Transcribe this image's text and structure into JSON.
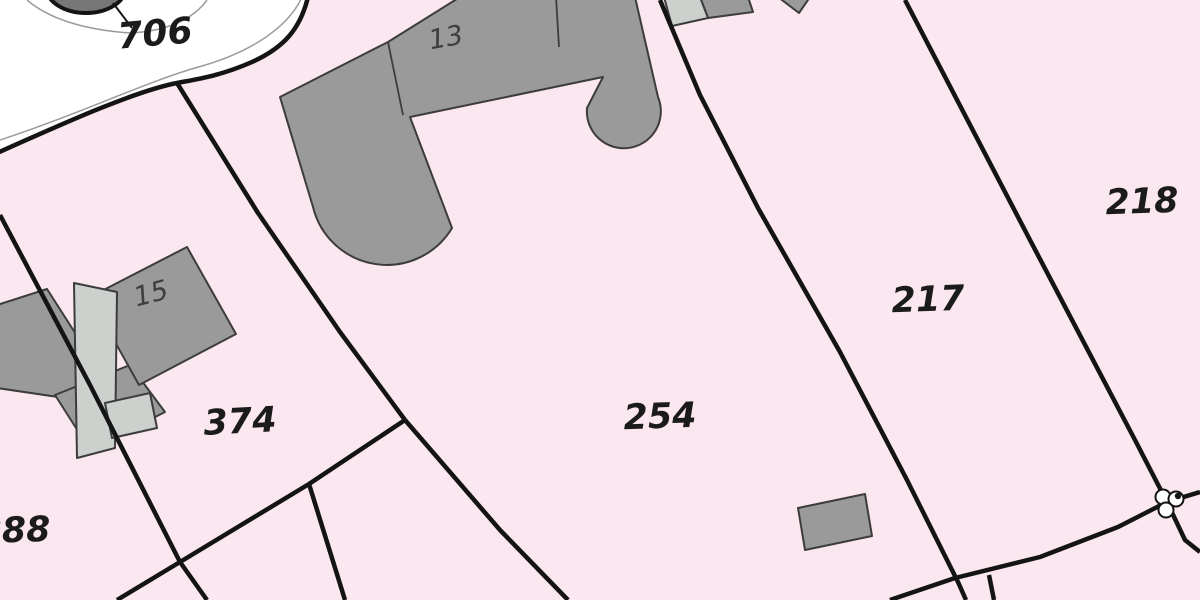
{
  "map": {
    "width": 1200,
    "height": 600,
    "colors": {
      "parcel_fill": "#fbe7ef",
      "road_fill": "#ffffff",
      "boundary": "#141414",
      "thin_line": "#9b9b9b",
      "building_dark": "#9a9a9a",
      "building_light": "#cdd1ce",
      "building_stroke": "#3c3c3c",
      "parcel_label_color": "#1b1b1b",
      "house_label_color": "#3e3e3e",
      "pond_fill": "#777777",
      "marker_fill": "#ffffff"
    },
    "parcel_labels": [
      {
        "id": "706",
        "text": "706",
        "x": 155,
        "y": 34,
        "size": 36,
        "rot": -5
      },
      {
        "id": "888",
        "text": "888",
        "x": 14,
        "y": 531,
        "size": 35,
        "rot": -2
      },
      {
        "id": "374",
        "text": "374",
        "x": 240,
        "y": 422,
        "size": 35,
        "rot": -3
      },
      {
        "id": "254",
        "text": "254",
        "x": 660,
        "y": 417,
        "size": 35,
        "rot": -2
      },
      {
        "id": "217",
        "text": "217",
        "x": 928,
        "y": 300,
        "size": 35,
        "rot": -2
      },
      {
        "id": "218",
        "text": "218",
        "x": 1142,
        "y": 202,
        "size": 35,
        "rot": -2
      }
    ],
    "house_labels": [
      {
        "id": "13",
        "text": "13",
        "x": 446,
        "y": 38,
        "size": 27,
        "rot": -10
      },
      {
        "id": "15",
        "text": "15",
        "x": 151,
        "y": 294,
        "size": 27,
        "rot": -15
      }
    ],
    "road_area_path": "M -3,-3 L 308,-3 C 300,30 283,48 252,62 C 220,76 198,79 177,83 C 135,91 62,124 -3,153 Z",
    "road_boundary_path": "M 308,-3 C 300,30 283,48 252,62 C 220,76 198,79 177,83 C 135,91 62,124 -3,153",
    "thin_curves": [
      {
        "id": "pond-ring",
        "path": "M 27,0 Q 60,28 130,33 Q 185,30 207,0"
      },
      {
        "id": "road-edge",
        "path": "M 302,-3 C 288,28 250,52 202,66 C 150,80 80,114 -3,141"
      }
    ],
    "pond": {
      "cx": 86,
      "cy": -13,
      "rx": 40,
      "ry": 26
    },
    "leader_line": [
      [
        113,
        3
      ],
      [
        132,
        28
      ]
    ],
    "boundary_lines": [
      {
        "id": "parcel-888-374",
        "points": [
          [
            0,
            215
          ],
          [
            90,
            385
          ],
          [
            180,
            562
          ],
          [
            207,
            600
          ]
        ]
      },
      {
        "id": "parcel-374-south",
        "points": [
          [
            405,
            420
          ],
          [
            309,
            484
          ],
          [
            180,
            562
          ],
          [
            117,
            600
          ]
        ]
      },
      {
        "id": "parcel-374-254",
        "points": [
          [
            177,
            83
          ],
          [
            258,
            213
          ],
          [
            340,
            332
          ],
          [
            405,
            420
          ]
        ]
      },
      {
        "id": "wedge-line",
        "points": [
          [
            309,
            484
          ],
          [
            345,
            600
          ]
        ]
      },
      {
        "id": "parcel-254-southwest",
        "points": [
          [
            405,
            420
          ],
          [
            500,
            530
          ],
          [
            568,
            600
          ]
        ]
      },
      {
        "id": "parcel-254-217",
        "points": [
          [
            660,
            0
          ],
          [
            700,
            95
          ],
          [
            758,
            208
          ],
          [
            840,
            352
          ],
          [
            907,
            480
          ],
          [
            958,
            582
          ],
          [
            966,
            600
          ]
        ]
      },
      {
        "id": "south-strip-line",
        "points": [
          [
            890,
            600
          ],
          [
            955,
            578
          ],
          [
            1040,
            557
          ],
          [
            1118,
            527
          ],
          [
            1167,
            502
          ],
          [
            1200,
            492
          ]
        ]
      },
      {
        "id": "south-branch",
        "points": [
          [
            989,
            575
          ],
          [
            994,
            600
          ]
        ]
      },
      {
        "id": "parcel-217-218",
        "points": [
          [
            905,
            0
          ],
          [
            1030,
            240
          ],
          [
            1135,
            440
          ],
          [
            1167,
            502
          ]
        ]
      },
      {
        "id": "corner-line",
        "points": [
          [
            1167,
            502
          ],
          [
            1185,
            540
          ],
          [
            1200,
            552
          ]
        ]
      }
    ],
    "building13": {
      "path": "M 280,97 L 388,42 L 460,-3 L 635,-3 L 658,97 A 37,37 0 1,1 587,108 L 603,77 L 410,117 L 452,228 A 76,76 0 0,1 313,207 Z",
      "inner_lines": [
        [
          [
            388,
            42
          ],
          [
            403,
            115
          ]
        ],
        [
          [
            556,
            -3
          ],
          [
            559,
            47
          ]
        ]
      ]
    },
    "buildings_dark": [
      {
        "id": "building-15-left-annex",
        "points": [
          [
            -3,
            305
          ],
          [
            47,
            289
          ],
          [
            104,
            378
          ],
          [
            58,
            397
          ],
          [
            -3,
            388
          ]
        ]
      },
      {
        "id": "building-15-lower-annex",
        "points": [
          [
            55,
            395
          ],
          [
            130,
            365
          ],
          [
            165,
            412
          ],
          [
            90,
            450
          ]
        ]
      },
      {
        "id": "building-15-main",
        "points": [
          [
            90,
            297
          ],
          [
            187,
            247
          ],
          [
            236,
            334
          ],
          [
            139,
            385
          ]
        ]
      },
      {
        "id": "shed-254",
        "points": [
          [
            798,
            508
          ],
          [
            865,
            494
          ],
          [
            872,
            536
          ],
          [
            805,
            550
          ]
        ]
      },
      {
        "id": "building-217-top-b",
        "points": [
          [
            700,
            -3
          ],
          [
            748,
            -3
          ],
          [
            753,
            12
          ],
          [
            708,
            18
          ]
        ]
      },
      {
        "id": "building-218-top-corner",
        "points": [
          [
            778,
            -3
          ],
          [
            810,
            -3
          ],
          [
            799,
            13
          ]
        ]
      }
    ],
    "buildings_light": [
      {
        "id": "building-15-slab",
        "points": [
          [
            74,
            283
          ],
          [
            117,
            292
          ],
          [
            115,
            448
          ],
          [
            77,
            458
          ]
        ]
      },
      {
        "id": "building-15-notch",
        "points": [
          [
            105,
            403
          ],
          [
            150,
            393
          ],
          [
            157,
            428
          ],
          [
            112,
            438
          ]
        ]
      },
      {
        "id": "building-217-top-a",
        "points": [
          [
            664,
            -3
          ],
          [
            700,
            -3
          ],
          [
            708,
            18
          ],
          [
            672,
            26
          ]
        ]
      }
    ],
    "boundary_marker": {
      "circles": [
        {
          "cx": 1163,
          "cy": 497,
          "r": 7.5
        },
        {
          "cx": 1176,
          "cy": 499,
          "r": 7.5
        },
        {
          "cx": 1166,
          "cy": 510,
          "r": 7.5
        }
      ],
      "dot": {
        "cx": 1178,
        "cy": 496,
        "r": 3.2
      }
    },
    "stroke_widths": {
      "boundary": 4.5,
      "thin": 1.5,
      "building": 2,
      "inner": 1.8,
      "pond": 4,
      "leader": 2,
      "marker": 2
    }
  }
}
